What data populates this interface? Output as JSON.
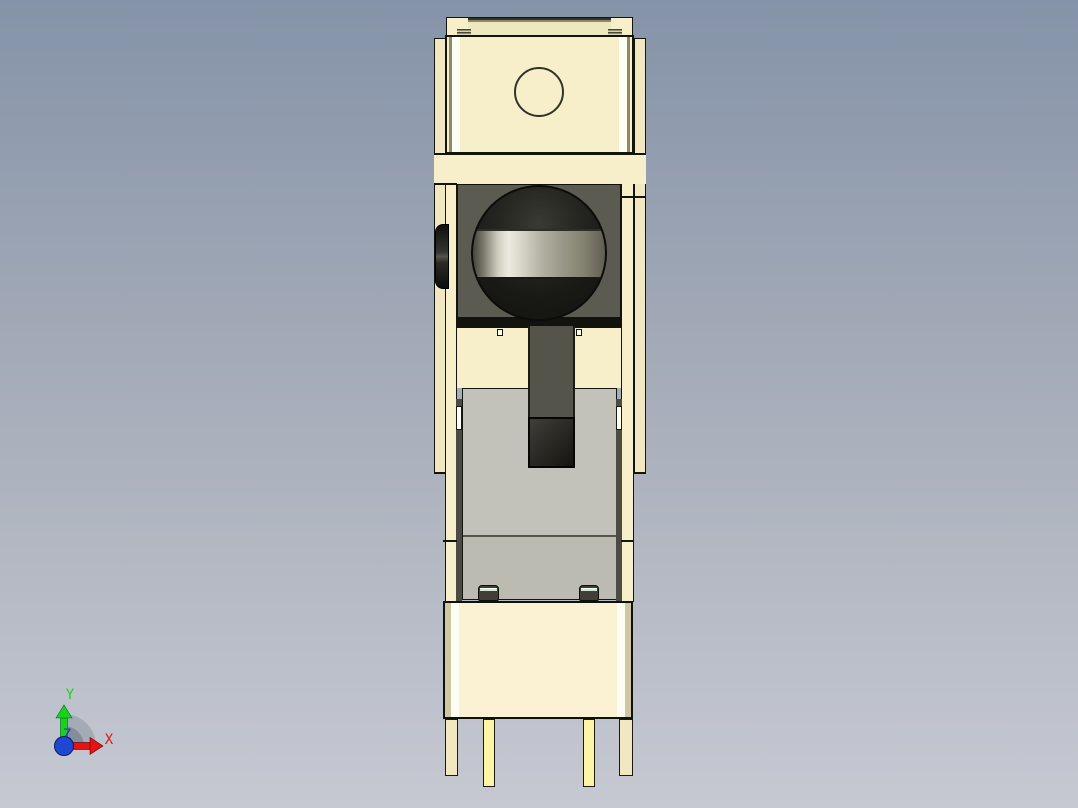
{
  "viewport": {
    "width": 1078,
    "height": 808,
    "background_top": "#8593a8",
    "background_mid": "#a9afbb",
    "background_bottom": "#c6c9d2"
  },
  "triad": {
    "axis_x": {
      "label": "X",
      "color": "#e41414"
    },
    "axis_y": {
      "label": "Y",
      "color": "#18d418"
    },
    "axis_z": {
      "label": "Z",
      "color": "#2438dc"
    }
  },
  "model": {
    "colors": {
      "cream": "#f7efc9",
      "cream_bright": "#faf2d2",
      "cream_shade": "#f1e8c2",
      "tan_edge": "#cfc6a2",
      "white_strip": "#fdfdf4",
      "olive_edge": "#8d8a69",
      "housing": "#5b5b51",
      "housing_deep": "#12120e",
      "arm": "#55544a",
      "sphere_hi": "#3a3a34",
      "sphere_lo": "#121210",
      "band_hi": "#edebdf",
      "band_lo": "#5f5e52",
      "slider": "#c2c2ba",
      "slider_lo": "#bbbbb2",
      "clip_body": "#3f3f38",
      "clip_accent": "#cdeccb",
      "pin": "#fcf5a5",
      "outline": "#14140f"
    }
  }
}
